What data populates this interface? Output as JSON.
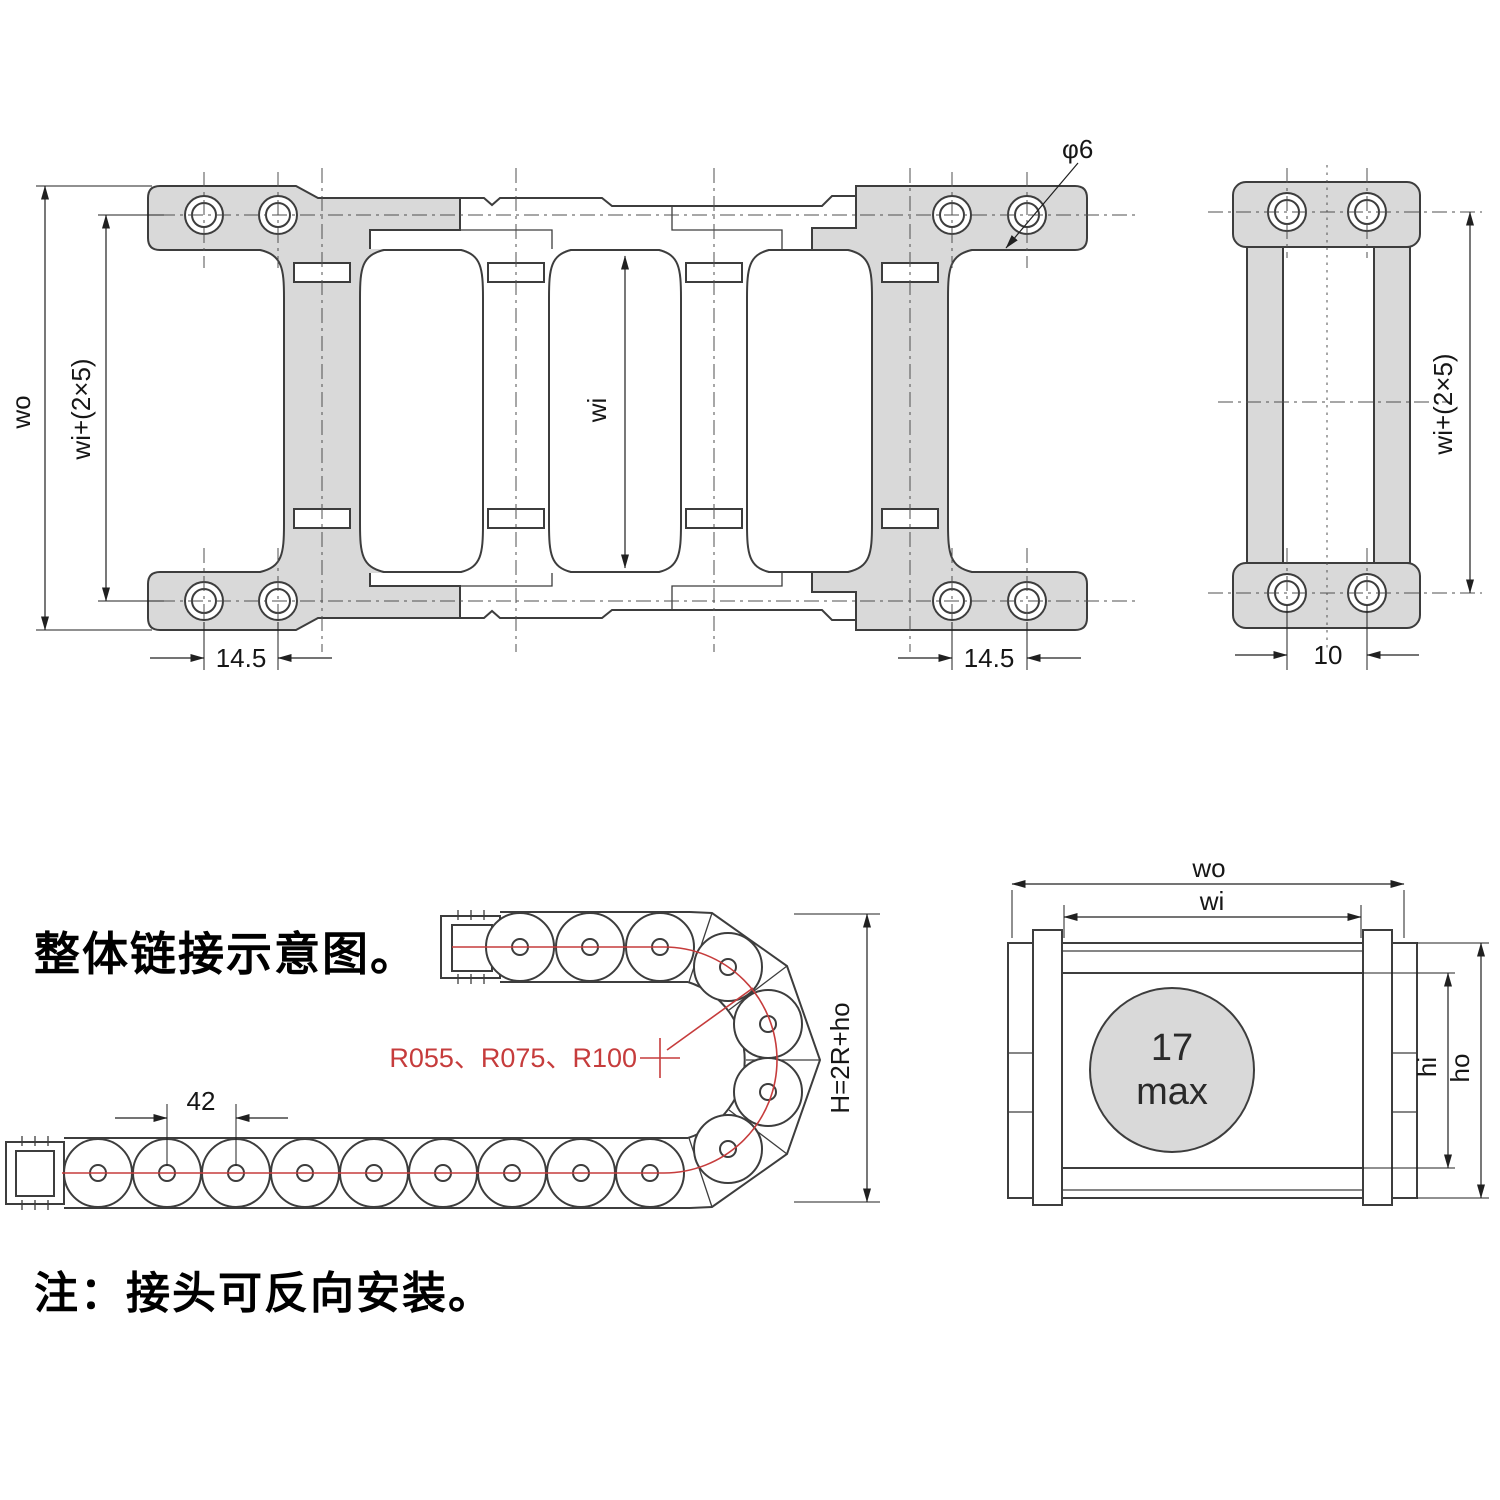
{
  "page": {
    "title": "整体链接示意图。",
    "note": "注：接头可反向安装。"
  },
  "plan_view": {
    "dim_outer_width": "wo",
    "dim_bolt_span": "wi+(2×5)",
    "dim_inner_width": "wi",
    "dim_hole_pitch_left": "14.5",
    "dim_hole_pitch_right": "14.5",
    "dim_hole_diameter": "φ6"
  },
  "side_view": {
    "dim_bolt_span": "wi+(2×5)",
    "dim_hole_spacing": "10"
  },
  "bend_view": {
    "dim_link_pitch": "42",
    "bend_radius_options": "R055、R075、R100",
    "dim_bend_height": "H=2R+ho"
  },
  "section_view": {
    "dim_outer_width": "wo",
    "dim_inner_width": "wi",
    "cable_size_value": "17",
    "cable_size_qualifier": "max",
    "dim_inner_height": "hi",
    "dim_outer_height": "ho"
  },
  "colors": {
    "part_fill": "#d9d9d9",
    "line_color": "#3d3d3d",
    "accent_red": "#c63c3c"
  }
}
